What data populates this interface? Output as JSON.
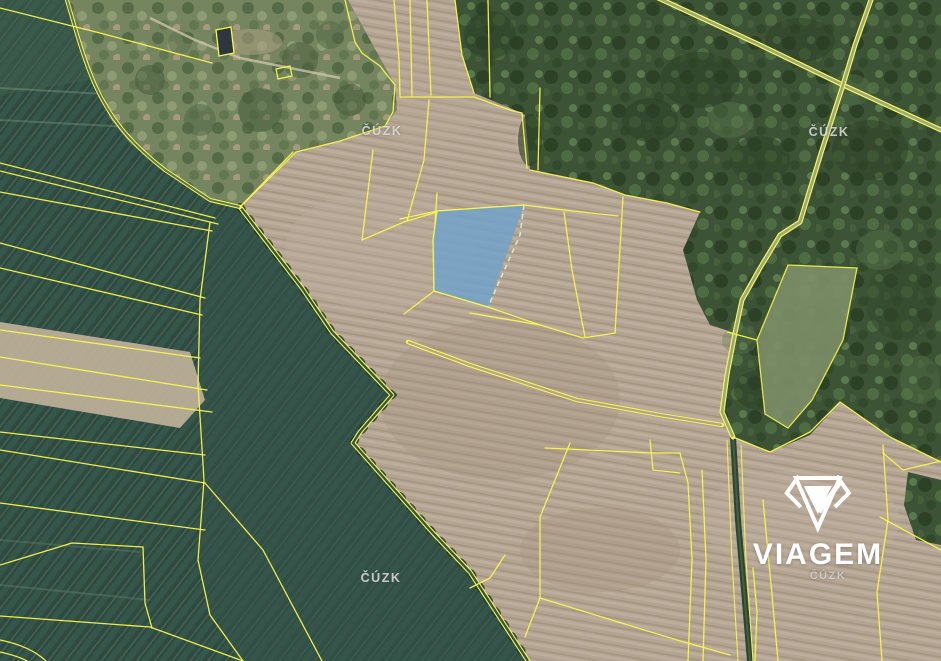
{
  "map": {
    "type": "aerial-cadastral-map",
    "provider_watermark": "ČÚZK",
    "watermarks": [
      {
        "position": "top-left",
        "text": "ČÚZK"
      },
      {
        "position": "top-right",
        "text": "ČÚZK"
      },
      {
        "position": "bottom-left",
        "text": "ČÚZK"
      },
      {
        "position": "bottom-right",
        "text": "ČÚZK"
      }
    ],
    "logo": {
      "brand": "VIAGEM"
    },
    "highlighted_parcel": {
      "fill": "#6FA2CC",
      "opacity": 0.82,
      "boundary_color": "#F9F64E",
      "edge_dash_color": "#D6EDC6"
    },
    "colors": {
      "parcel_line": "#F9F64E",
      "field_tan": "#B3A392",
      "field_green": "#2F4A41",
      "forest": "#3C5336",
      "scrub": "#75855F",
      "watermark_text": "#E4E6E2",
      "logo_text": "#FFFFFF"
    }
  }
}
